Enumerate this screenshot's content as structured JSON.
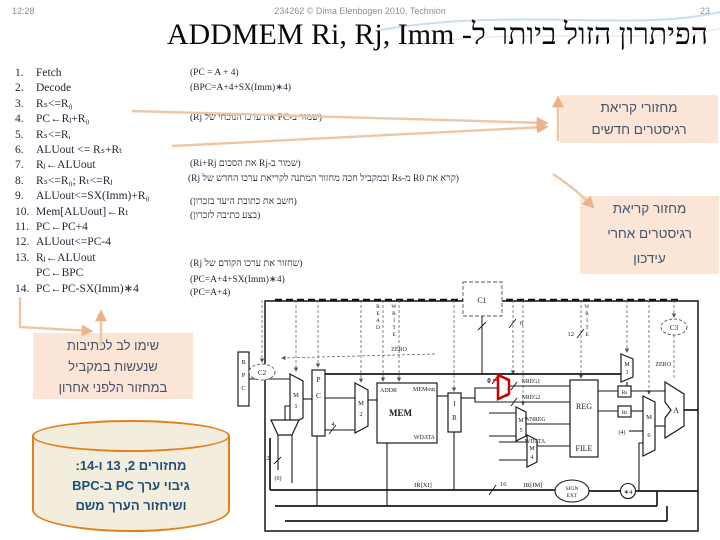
{
  "header": {
    "time": "12:28",
    "course": "234262 © Dima Elenbogen 2010, Technion",
    "page": "23"
  },
  "title": "הפיתרון הזול ביותר ל- ADDMEM Ri, Rj, Imm",
  "steps": [
    {
      "num": "1.",
      "text": "Fetch"
    },
    {
      "num": "2.",
      "text": "Decode"
    },
    {
      "num": "3.",
      "text": "Rₛ<=R₀"
    },
    {
      "num": "4.",
      "text": "PC←Rⱼ+R₀"
    },
    {
      "num": "5.",
      "text": "Rₛ<=Rᵢ"
    },
    {
      "num": "6.",
      "text": "ALUout <= Rₛ+Rₜ"
    },
    {
      "num": "7.",
      "text": "Rⱼ←ALUout"
    },
    {
      "num": "8.",
      "text": "Rₛ<=R₀; Rₜ<=Rⱼ"
    },
    {
      "num": "9.",
      "text": "ALUout<=SX(Imm)+R₀"
    },
    {
      "num": "10.",
      "text": "Mem[ALUout]←Rₜ"
    },
    {
      "num": "11.",
      "text": "PC←PC+4"
    },
    {
      "num": "12.",
      "text": "ALUout<=PC-4"
    },
    {
      "num": "13.",
      "text": "Rⱼ←ALUout"
    },
    {
      "num": "",
      "text": "PC←BPC"
    },
    {
      "num": "14.",
      "text": "PC←PC-SX(Imm)∗4"
    }
  ],
  "annotations": [
    "(PC = A + 4)",
    "(BPC=A+4+SX(Imm)∗4)",
    "(שמור ב-PC את ערכו הנוכחי של Rj)",
    "(שמור ב-Rj את הסכום Ri+Rj)",
    "(קרא את R0 מ-Rs ובמקביל חכה מחזור המתנה לקריאת ערכו החדש של Rj)",
    "(חשב את כתובת היעד בזכרון)",
    "(בצע כתיבה לזכרון)",
    "(שחזור את ערכו הקודם של Rj)",
    "(PC=A+4+SX(Imm)∗4)",
    "(PC=A+4)"
  ],
  "callouts": {
    "new_reads": {
      "lines": [
        "מחזורי קריאת",
        "רגיסטרים חדשים"
      ]
    },
    "read_after_update": {
      "lines": [
        "מחזור קריאת",
        "רגיסטרים אחרי",
        "עידכון"
      ]
    },
    "parallel_writes": {
      "lines": [
        "שימו לב לכתיבות",
        "שנעשות במקביל",
        "במחזור הלפני אחרון"
      ]
    },
    "cylinder": {
      "lines": [
        "מחזורים 2, 13 ו-14:",
        "גיבוי ערך PC ב-BPC",
        "ושיחזור הערך משם"
      ]
    }
  },
  "colors": {
    "callout_fill": "#fbe5d6",
    "callout_text": "#44546a",
    "cylinder_fill": "#f2eddc",
    "cylinder_border": "#e0811c",
    "cylinder_text": "#1f4e79",
    "arrow": "#f0c6a2",
    "red_highlight": "#cc0000"
  },
  "diagram": {
    "labels": {
      "c1": "C1",
      "c2": "C2",
      "c3": "C3",
      "bpc": "BPC",
      "pc": "PC",
      "ir": "IR",
      "m1": "M",
      "m1n": "1",
      "m2": "M",
      "m2n": "2",
      "m3": "M",
      "m3n": "3",
      "m4": "M",
      "m4n": "4",
      "m5": "M",
      "m5n": "5",
      "m6": "M",
      "m6n": "6",
      "mem": "MEM",
      "addr": "ADDR",
      "memout": "MEMout",
      "wdata_mem": "WDATA",
      "read": "READ",
      "write_mem": "WRITE",
      "write_reg": "WRITE",
      "w12": "12",
      "w6": "6",
      "w4": "4",
      "w2": "2",
      "w0": "(0)",
      "w16": "16",
      "mul4": "∗4",
      "zero_l": "ZERO",
      "zero_r": "ZERO",
      "nreg1": "NREG1",
      "nreg2": "NREG2",
      "wnreg": "WNREG",
      "wdata_rf": "WDATA",
      "reg": "REG",
      "file": "FILE",
      "rs": "Rs",
      "rt": "Rt",
      "const4": "(4)",
      "alu": "A",
      "irxi": "IR[XI]",
      "irim": "IR[IM]",
      "sign": "SIGN",
      "ext": "EXT",
      "red0": "0",
      "b5a": "5",
      "b5b": "5"
    }
  }
}
